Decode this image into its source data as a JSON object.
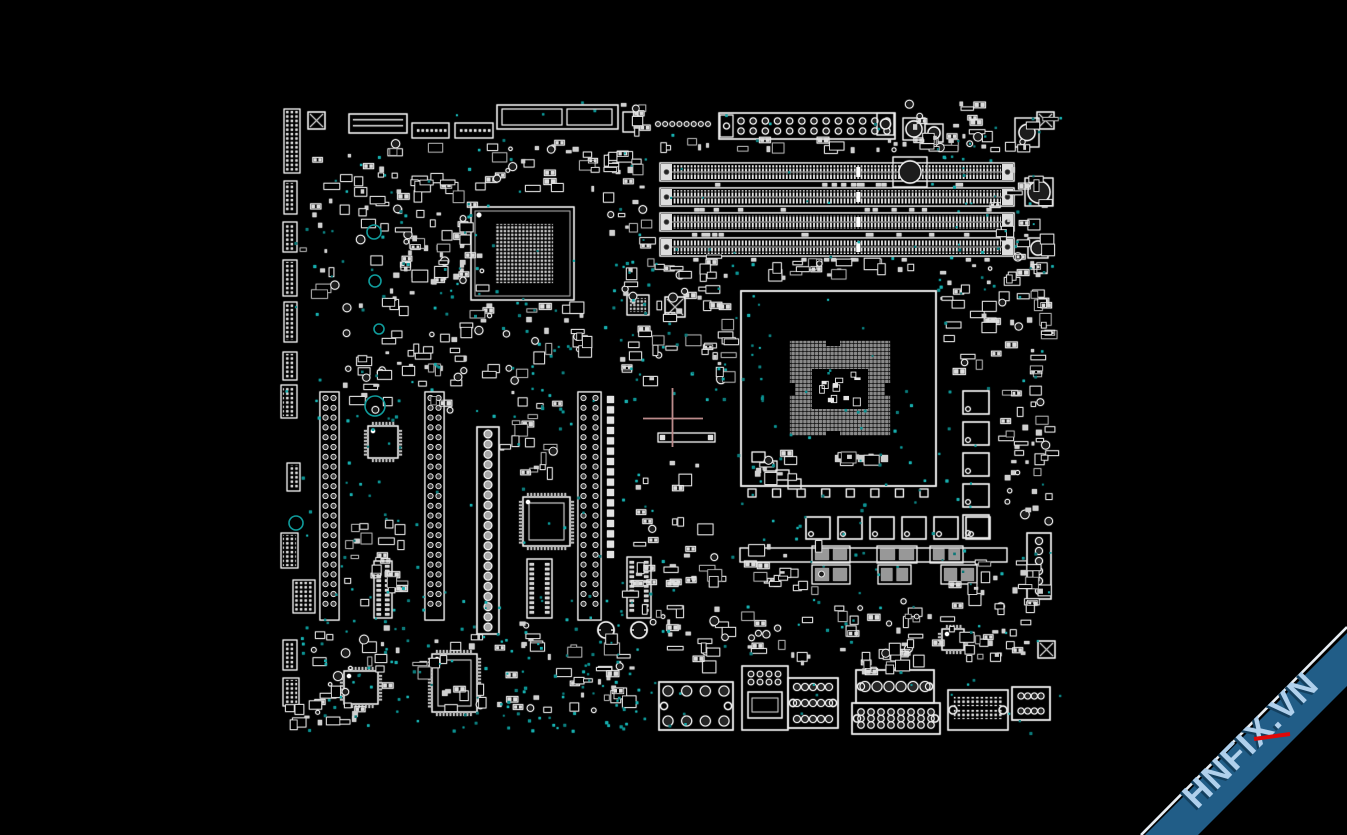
{
  "app": {
    "background": "#000000",
    "canvas_width": 1347,
    "canvas_height": 835
  },
  "watermark": {
    "text": "HNFIX.VN",
    "band_color": "#215d87",
    "edge_color": "#e7edf3",
    "text_color": "#b0d0ec",
    "text_shadow_color": "#14405f",
    "accent_color": "#e00808"
  },
  "viewer": {
    "palette": {
      "stroke": "#e9e9e9",
      "dim": "#b9b9b9",
      "pad": "#d4d4d4",
      "gray": "#8d8d8d",
      "dark": "#2a2a2a",
      "via_colors": [
        "#0d8f8f",
        "#16abab",
        "#0a7878"
      ],
      "crosshair": "#bc8b8b"
    },
    "crosshair": {
      "x": 672.5,
      "y": 418.5,
      "left": 643,
      "right": 703,
      "top": 388,
      "bottom": 447
    }
  },
  "board": {
    "region": [
      283,
      100,
      779,
      635
    ],
    "components": [
      {
        "t": "dimm",
        "b": [
          660,
          163,
          354,
          18
        ]
      },
      {
        "t": "dimm",
        "b": [
          660,
          188,
          354,
          18
        ]
      },
      {
        "t": "dimm",
        "b": [
          660,
          213,
          354,
          18
        ]
      },
      {
        "t": "dimm",
        "b": [
          660,
          238,
          354,
          18
        ]
      },
      {
        "t": "caprow",
        "b": [
          690,
          183,
          315,
          4
        ],
        "n": 13,
        "seed": 11
      },
      {
        "t": "caprow",
        "b": [
          690,
          208,
          315,
          4
        ],
        "n": 11,
        "seed": 12
      },
      {
        "t": "caprow",
        "b": [
          690,
          233,
          315,
          4
        ],
        "n": 12,
        "seed": 13
      },
      {
        "t": "caprow",
        "b": [
          690,
          258,
          315,
          4
        ],
        "n": 10,
        "seed": 14
      },
      {
        "t": "socket",
        "b": [
          741,
          291,
          195,
          195
        ],
        "grid": [
          790,
          341,
          100,
          95
        ],
        "cut": [
          812,
          369,
          56,
          40
        ],
        "seed": 21
      },
      {
        "t": "sqrow",
        "b": [
          748,
          489,
          180,
          8
        ],
        "n": 8
      },
      {
        "t": "bga",
        "b": [
          471,
          207,
          103,
          93
        ],
        "grid": [
          495,
          224,
          58,
          59
        ]
      },
      {
        "t": "bgasmall",
        "b": [
          627,
          295,
          22,
          20
        ]
      },
      {
        "t": "slotv",
        "b": [
          320,
          392,
          19,
          228
        ]
      },
      {
        "t": "slotv",
        "b": [
          425,
          392,
          19,
          228
        ]
      },
      {
        "t": "slotv",
        "b": [
          578,
          392,
          23,
          228
        ]
      },
      {
        "t": "sqcol",
        "b": [
          607,
          396,
          10,
          162
        ],
        "n": 16
      },
      {
        "t": "atx",
        "b": [
          477,
          427,
          22,
          207
        ],
        "n": 20
      },
      {
        "t": "qfp",
        "b": [
          368,
          426,
          30,
          32
        ]
      },
      {
        "t": "qfp",
        "b": [
          523,
          497,
          47,
          49
        ]
      },
      {
        "t": "qfp",
        "b": [
          344,
          671,
          34,
          33
        ]
      },
      {
        "t": "qfp",
        "b": [
          432,
          654,
          45,
          58
        ]
      },
      {
        "t": "qfp",
        "b": [
          942,
          629,
          22,
          21
        ]
      },
      {
        "t": "sop",
        "b": [
          374,
          561,
          18,
          57
        ]
      },
      {
        "t": "sop",
        "b": [
          527,
          559,
          25,
          59
        ]
      },
      {
        "t": "sop",
        "b": [
          627,
          557,
          24,
          61
        ]
      },
      {
        "t": "chokerow",
        "x": 806,
        "y": 517,
        "n": 6,
        "dx": 32,
        "w": 24,
        "h": 22
      },
      {
        "t": "chokecol",
        "x": 963,
        "y": 391,
        "n": 5,
        "dy": 31,
        "w": 26,
        "h": 23
      },
      {
        "t": "mos",
        "b": [
          812,
          546,
          38,
          17
        ]
      },
      {
        "t": "mos",
        "b": [
          877,
          546,
          40,
          17
        ]
      },
      {
        "t": "mos",
        "b": [
          930,
          546,
          33,
          17
        ]
      },
      {
        "t": "mos",
        "b": [
          812,
          565,
          38,
          19
        ]
      },
      {
        "t": "mos",
        "b": [
          878,
          565,
          33,
          19
        ]
      },
      {
        "t": "mos",
        "b": [
          941,
          565,
          36,
          19
        ]
      },
      {
        "t": "orect",
        "b": [
          740,
          548,
          267,
          14
        ]
      },
      {
        "t": "longbar",
        "b": [
          658,
          433,
          57,
          9
        ]
      },
      {
        "t": "pinheader2",
        "b": [
          719,
          113,
          176,
          26
        ],
        "n": 13
      },
      {
        "t": "circlesrow",
        "b": [
          658,
          118,
          50,
          12
        ],
        "n": 8
      },
      {
        "t": "connlines",
        "b": [
          349,
          114,
          58,
          19
        ]
      },
      {
        "t": "headerh",
        "b": [
          412,
          123,
          37,
          15
        ],
        "n": 7
      },
      {
        "t": "headerh",
        "b": [
          455,
          123,
          38,
          15
        ],
        "n": 7
      },
      {
        "t": "bigbox2",
        "b": [
          497,
          105,
          121,
          24
        ]
      },
      {
        "t": "orect",
        "b": [
          623,
          112,
          15,
          20
        ]
      },
      {
        "t": "xsquare",
        "b": [
          308,
          112,
          17
        ]
      },
      {
        "t": "xsquare",
        "b": [
          1037,
          112,
          17
        ]
      },
      {
        "t": "xsquare",
        "b": [
          1038,
          641,
          17
        ]
      },
      {
        "t": "xsquare",
        "b": [
          665,
          297,
          20
        ]
      },
      {
        "t": "capbox",
        "b": [
          877,
          113,
          17,
          22
        ],
        "r": 5
      },
      {
        "t": "capbox",
        "b": [
          903,
          118,
          22,
          22
        ],
        "r": 8
      },
      {
        "t": "capbox",
        "b": [
          925,
          124,
          18,
          18
        ],
        "r": 6
      },
      {
        "t": "capbox",
        "b": [
          893,
          157,
          34,
          30
        ],
        "r": 11
      },
      {
        "t": "capbox",
        "b": [
          1015,
          118,
          24,
          29
        ],
        "r": 8
      },
      {
        "t": "capbox",
        "b": [
          1025,
          178,
          28,
          28
        ],
        "r": 11
      },
      {
        "t": "capbox",
        "b": [
          1028,
          238,
          20,
          20
        ],
        "r": 7
      },
      {
        "t": "ioportv",
        "b": [
          1027,
          533,
          24,
          66
        ],
        "n": 6
      },
      {
        "t": "screw",
        "c": [
          606,
          630
        ],
        "r": 8
      },
      {
        "t": "screw",
        "c": [
          639,
          630
        ],
        "r": 8
      },
      {
        "t": "ioport",
        "b": [
          659,
          682,
          74,
          48
        ],
        "rows": 2,
        "cols": 4,
        "r": 5,
        "corner": true
      },
      {
        "t": "usbport",
        "b": [
          742,
          666,
          46,
          64
        ]
      },
      {
        "t": "ioport",
        "b": [
          788,
          678,
          50,
          50
        ],
        "rows": 3,
        "cols": 5,
        "r": 3.5,
        "corner": true
      },
      {
        "t": "ioport",
        "b": [
          856,
          670,
          78,
          33
        ],
        "rows": 1,
        "cols": 6,
        "r": 5,
        "corner": true
      },
      {
        "t": "ioport",
        "b": [
          852,
          703,
          88,
          31
        ],
        "rows": 3,
        "cols": 8,
        "r": 3.2,
        "corner": true
      },
      {
        "t": "pinport",
        "b": [
          948,
          690,
          60,
          40
        ]
      },
      {
        "t": "ioport",
        "b": [
          1012,
          687,
          38,
          33
        ],
        "rows": 2,
        "cols": 4,
        "r": 3,
        "corner": false
      },
      {
        "t": "headerv",
        "b": [
          284,
          109,
          16,
          64
        ]
      },
      {
        "t": "headerv",
        "b": [
          284,
          181,
          13,
          33
        ]
      },
      {
        "t": "headerv",
        "b": [
          283,
          222,
          14,
          30
        ]
      },
      {
        "t": "headerv",
        "b": [
          283,
          260,
          14,
          36
        ]
      },
      {
        "t": "headerv",
        "b": [
          284,
          302,
          13,
          40
        ]
      },
      {
        "t": "headerv",
        "b": [
          283,
          352,
          14,
          28
        ]
      },
      {
        "t": "headerv",
        "b": [
          281,
          385,
          16,
          33
        ]
      },
      {
        "t": "headerv",
        "b": [
          287,
          463,
          13,
          28
        ]
      },
      {
        "t": "headerv",
        "b": [
          281,
          533,
          17,
          35
        ]
      },
      {
        "t": "headerv",
        "b": [
          293,
          580,
          22,
          33
        ]
      },
      {
        "t": "headerv",
        "b": [
          283,
          640,
          14,
          30
        ]
      },
      {
        "t": "headerv",
        "b": [
          283,
          678,
          16,
          28
        ]
      }
    ],
    "clusters": [
      [
        300,
        140,
        165,
        180,
        60,
        101
      ],
      [
        390,
        170,
        110,
        130,
        35,
        102
      ],
      [
        480,
        140,
        175,
        60,
        30,
        103
      ],
      [
        600,
        148,
        58,
        112,
        20,
        104
      ],
      [
        615,
        255,
        130,
        135,
        48,
        105
      ],
      [
        340,
        330,
        130,
        95,
        40,
        106
      ],
      [
        455,
        300,
        110,
        90,
        26,
        107
      ],
      [
        500,
        390,
        70,
        100,
        20,
        108
      ],
      [
        340,
        520,
        80,
        95,
        25,
        109
      ],
      [
        620,
        460,
        115,
        170,
        40,
        110
      ],
      [
        300,
        620,
        330,
        100,
        70,
        111
      ],
      [
        650,
        612,
        175,
        62,
        35,
        112
      ],
      [
        830,
        598,
        225,
        70,
        50,
        113
      ],
      [
        940,
        262,
        118,
        126,
        40,
        114
      ],
      [
        895,
        100,
        165,
        58,
        30,
        115
      ],
      [
        990,
        160,
        70,
        108,
        20,
        116
      ],
      [
        995,
        390,
        58,
        148,
        24,
        117
      ],
      [
        1030,
        260,
        32,
        290,
        28,
        118
      ],
      [
        660,
        138,
        350,
        22,
        26,
        119
      ],
      [
        740,
        540,
        96,
        66,
        18,
        120
      ],
      [
        950,
        560,
        108,
        58,
        22,
        121
      ],
      [
        860,
        640,
        70,
        42,
        15,
        122
      ],
      [
        620,
        100,
        40,
        40,
        8,
        123
      ],
      [
        755,
        450,
        55,
        38,
        10,
        124
      ],
      [
        835,
        452,
        60,
        16,
        10,
        125
      ],
      [
        700,
        272,
        42,
        112,
        15,
        126
      ],
      [
        460,
        212,
        16,
        78,
        10,
        127
      ],
      [
        283,
        700,
        90,
        32,
        14,
        128
      ],
      [
        560,
        300,
        40,
        80,
        12,
        129
      ],
      [
        750,
        258,
        180,
        30,
        20,
        130
      ],
      [
        596,
        648,
        60,
        60,
        12,
        131
      ]
    ],
    "vias": [
      [
        285,
        100,
        775,
        635,
        200,
        201
      ],
      [
        290,
        595,
        340,
        135,
        70,
        202
      ],
      [
        600,
        248,
        165,
        155,
        45,
        203
      ],
      [
        930,
        100,
        132,
        200,
        35,
        204
      ],
      [
        745,
        378,
        245,
        255,
        50,
        205
      ],
      [
        430,
        298,
        145,
        125,
        28,
        206
      ],
      [
        282,
        378,
        125,
        300,
        35,
        207
      ],
      [
        480,
        640,
        210,
        92,
        35,
        208
      ],
      [
        330,
        150,
        150,
        170,
        30,
        209
      ]
    ],
    "rings": [
      [
        374,
        232,
        7
      ],
      [
        375,
        281,
        6
      ],
      [
        379,
        329,
        5
      ],
      [
        375,
        406,
        10
      ],
      [
        296,
        523,
        7
      ]
    ]
  }
}
